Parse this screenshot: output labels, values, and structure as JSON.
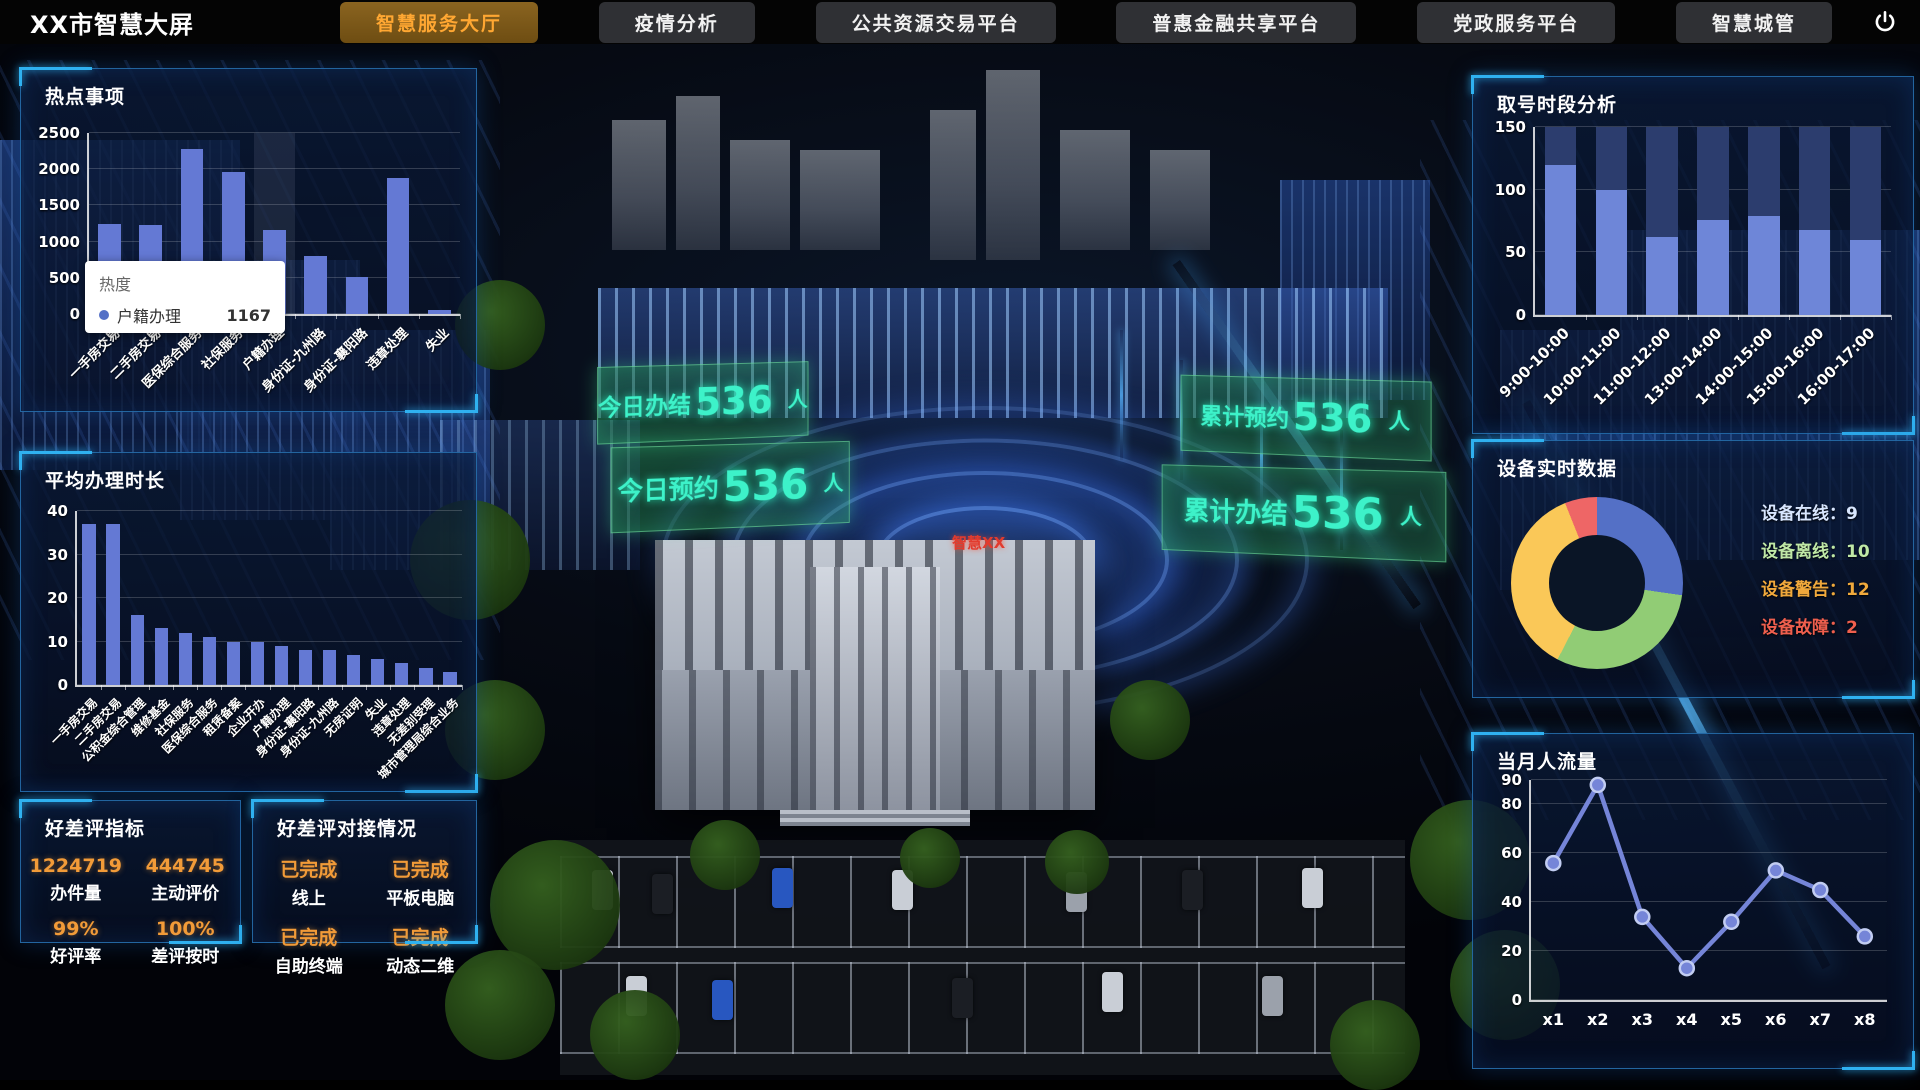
{
  "header": {
    "title": "XX市智慧大屏",
    "tabs": [
      {
        "label": "智慧服务大厅",
        "active": true
      },
      {
        "label": "疫情分析",
        "active": false
      },
      {
        "label": "公共资源交易平台",
        "active": false
      },
      {
        "label": "普惠金融共享平台",
        "active": false
      },
      {
        "label": "党政服务平台",
        "active": false
      },
      {
        "label": "智慧城管",
        "active": false
      }
    ],
    "power_icon": "power-icon"
  },
  "chart_data": [
    {
      "id": "hot_topics",
      "type": "bar",
      "title": "热点事项",
      "categories": [
        "一手房交易",
        "二手房交易",
        "医保综合服务",
        "社保服务",
        "户籍办理",
        "身份证-九州路",
        "身份证-襄阳路",
        "违章处理",
        "失业"
      ],
      "values": [
        1250,
        1230,
        2280,
        1960,
        1167,
        800,
        510,
        1880,
        50
      ],
      "ylim": [
        0,
        2500
      ],
      "yticks": [
        0,
        500,
        1000,
        1500,
        2000,
        2500
      ],
      "highlight_index": 4,
      "bar_color": "#6479d4",
      "tooltip": {
        "title": "热度",
        "series": "户籍办理",
        "value": "1167"
      }
    },
    {
      "id": "avg_time",
      "type": "bar",
      "title": "平均办理时长",
      "categories": [
        "一手房交易",
        "二手房交易",
        "公积金综合管理",
        "维修基金",
        "社保服务",
        "医保综合服务",
        "租赁备案",
        "企业开办",
        "户籍办理",
        "身份证-襄阳路",
        "身份证-九州路",
        "无房证明",
        "失业",
        "违章处理",
        "无差别受理",
        "城市管理局综合业务"
      ],
      "values": [
        37,
        37,
        16,
        13,
        12,
        11,
        10,
        10,
        9,
        8,
        8,
        7,
        6,
        5,
        4,
        3
      ],
      "ylim": [
        0,
        40
      ],
      "yticks": [
        0,
        10,
        20,
        30,
        40
      ],
      "bar_color": "#6479d4"
    },
    {
      "id": "queue_period",
      "type": "bar",
      "title": "取号时段分析",
      "categories": [
        "9:00-10:00",
        "10:00-11:00",
        "11:00-12:00",
        "13:00-14:00",
        "14:00-15:00",
        "15:00-16:00",
        "16:00-17:00"
      ],
      "values": [
        120,
        100,
        62,
        76,
        79,
        68,
        60
      ],
      "track": 150,
      "ylim": [
        0,
        150
      ],
      "yticks": [
        0,
        50,
        100,
        150
      ],
      "bar_color": "#6e86d8",
      "track_color": "#2c3d6e",
      "bar_pct": 62
    },
    {
      "id": "device_realtime",
      "type": "pie",
      "title": "设备实时数据",
      "items": [
        {
          "label": "设备在线",
          "value": 9,
          "color": "#5470c6",
          "text_color": "#d8e6ff"
        },
        {
          "label": "设备离线",
          "value": 10,
          "color": "#91cc75",
          "text_color": "#bfe8a6"
        },
        {
          "label": "设备警告",
          "value": 12,
          "color": "#fac858",
          "text_color": "#f0a93c"
        },
        {
          "label": "设备故障",
          "value": 2,
          "color": "#ee6666",
          "text_color": "#ef5f4e"
        }
      ]
    },
    {
      "id": "month_visitors",
      "type": "line",
      "title": "当月人流量",
      "x": [
        "x1",
        "x2",
        "x3",
        "x4",
        "x5",
        "x6",
        "x7",
        "x8"
      ],
      "values": [
        56,
        88,
        34,
        13,
        32,
        53,
        45,
        26
      ],
      "ylim": [
        0,
        90
      ],
      "yticks": [
        0,
        20,
        40,
        60,
        80,
        90
      ],
      "line_color": "#7585d8"
    }
  ],
  "left": {
    "ratings": {
      "title": "好差评指标",
      "items": [
        {
          "value": "1224719",
          "label": "办件量"
        },
        {
          "value": "444745",
          "label": "主动评价"
        },
        {
          "value": "99%",
          "label": "好评率"
        },
        {
          "value": "100%",
          "label": "差评按时"
        }
      ]
    },
    "docking": {
      "title": "好差评对接情况",
      "items": [
        {
          "value": "已完成",
          "label": "线上"
        },
        {
          "value": "已完成",
          "label": "平板电脑"
        },
        {
          "value": "已完成",
          "label": "自助终端"
        },
        {
          "value": "已完成",
          "label": "动态二维"
        }
      ]
    }
  },
  "scene": {
    "building_label": "智慧XX",
    "labels": [
      {
        "text": "今日办结",
        "value": "536",
        "unit": "人"
      },
      {
        "text": "今日预约",
        "value": "536",
        "unit": "人"
      },
      {
        "text": "累计预约",
        "value": "536",
        "unit": "人"
      },
      {
        "text": "累计办结",
        "value": "536",
        "unit": "人"
      }
    ]
  },
  "colors": {
    "accent_orange": "#f29b38",
    "tab_active_text": "#ffa732",
    "bar_blue": "#6479d4",
    "holo_cyan": "#3df2c9",
    "panel_border": "#2873b4"
  }
}
